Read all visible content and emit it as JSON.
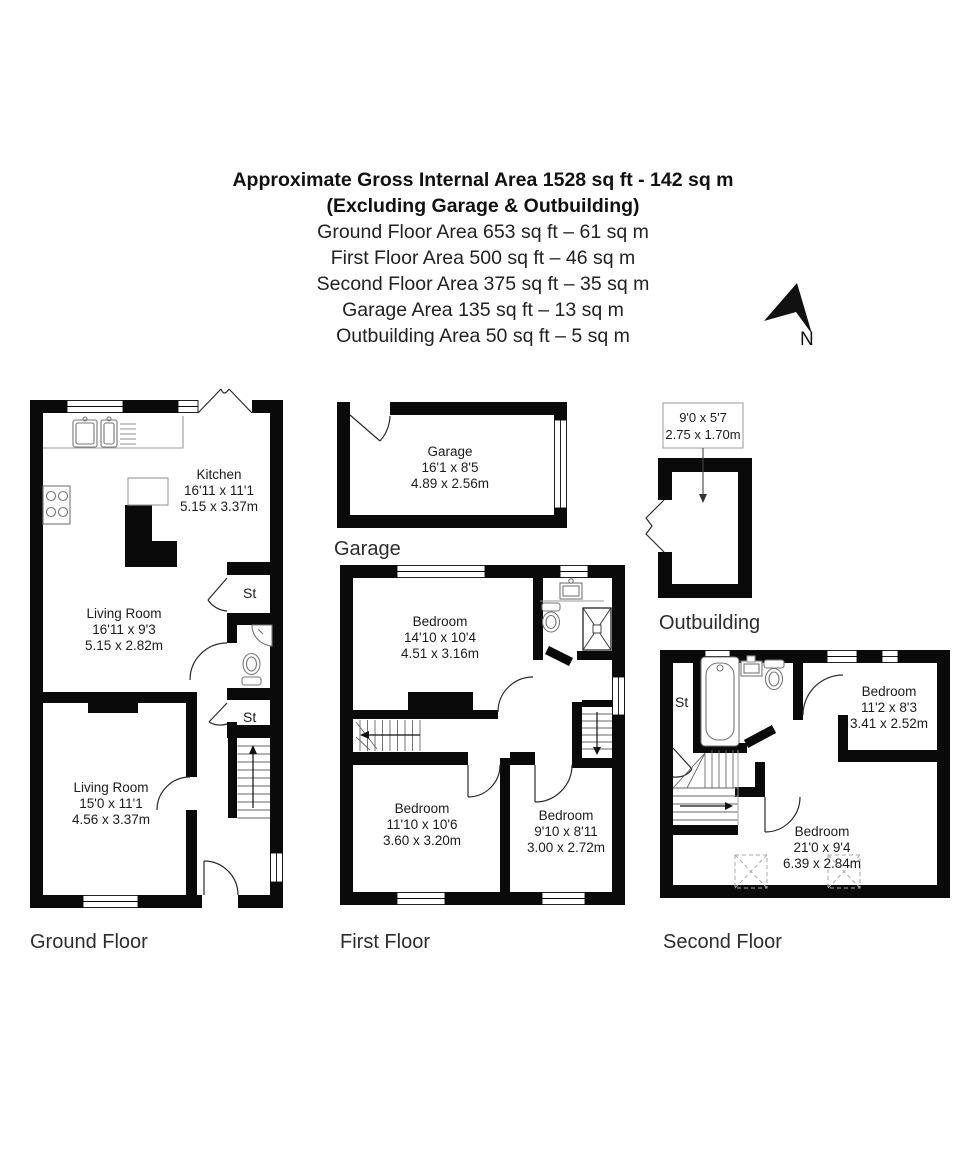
{
  "header": {
    "line1": "Approximate Gross Internal Area 1528 sq ft - 142 sq m",
    "line2": "(Excluding Garage & Outbuilding)",
    "areas": [
      "Ground Floor Area 653 sq ft – 61 sq m",
      "First Floor Area 500 sq ft – 46 sq m",
      "Second Floor Area 375 sq ft – 35 sq m",
      "Garage Area 135 sq ft – 13 sq m",
      "Outbuilding Area 50 sq ft – 5 sq m"
    ]
  },
  "compass": {
    "label": "N"
  },
  "ground_floor": {
    "label": "Ground Floor",
    "rooms": {
      "kitchen": {
        "name": "Kitchen",
        "imperial": "16'11 x 11'1",
        "metric": "5.15 x 3.37m"
      },
      "living1": {
        "name": "Living Room",
        "imperial": "16'11 x 9'3",
        "metric": "5.15 x 2.82m"
      },
      "living2": {
        "name": "Living Room",
        "imperial": "15'0 x 11'1",
        "metric": "4.56 x 3.37m"
      },
      "store1": {
        "name": "St"
      },
      "store2": {
        "name": "St"
      }
    }
  },
  "garage": {
    "label": "Garage",
    "room": {
      "name": "Garage",
      "imperial": "16'1 x 8'5",
      "metric": "4.89 x 2.56m"
    }
  },
  "first_floor": {
    "label": "First Floor",
    "rooms": {
      "bed1": {
        "name": "Bedroom",
        "imperial": "14'10 x 10'4",
        "metric": "4.51 x 3.16m"
      },
      "bed2": {
        "name": "Bedroom",
        "imperial": "11'10 x 10'6",
        "metric": "3.60 x 3.20m"
      },
      "bed3": {
        "name": "Bedroom",
        "imperial": "9'10 x 8'11",
        "metric": "3.00 x 2.72m"
      }
    }
  },
  "second_floor": {
    "label": "Second Floor",
    "rooms": {
      "store": {
        "name": "St"
      },
      "bed1": {
        "name": "Bedroom",
        "imperial": "11'2 x 8'3",
        "metric": "3.41 x 2.52m"
      },
      "bed2": {
        "name": "Bedroom",
        "imperial": "21'0 x 9'4",
        "metric": "6.39 x 2.84m"
      }
    }
  },
  "outbuilding": {
    "label": "Outbuilding",
    "dims": {
      "imperial": "9'0 x 5'7",
      "metric": "2.75 x 1.70m"
    }
  },
  "colors": {
    "wall": "#0a0a0a",
    "fixture": "#777777",
    "text": "#1c1c1c"
  }
}
